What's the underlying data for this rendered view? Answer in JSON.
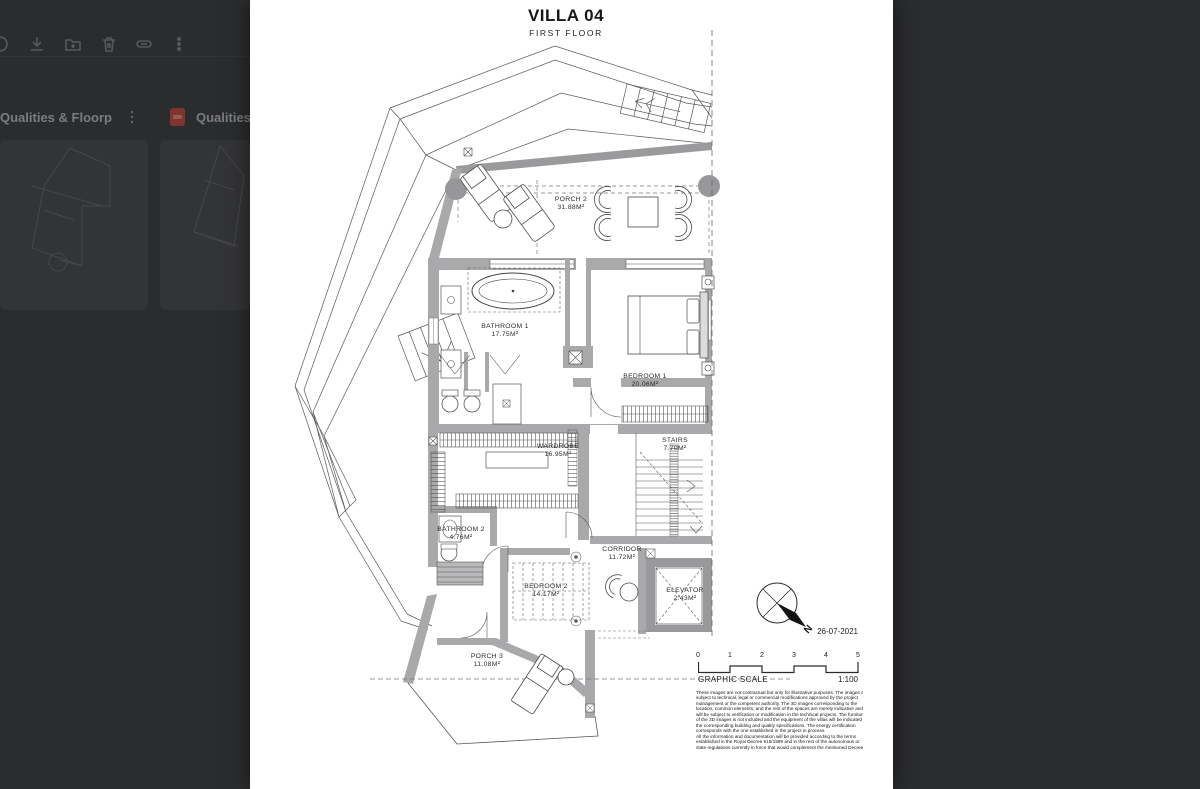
{
  "backdrop": {
    "toolbar": {
      "icons": [
        "partial-icon",
        "download-icon",
        "add-to-folder-icon",
        "trash-icon",
        "link-icon",
        "more-options-icon"
      ]
    },
    "cards": [
      {
        "title": "Qualities & Floorpla...",
        "type": "pdf"
      },
      {
        "title": "Qualities & Floorpla...",
        "type": "pdf"
      }
    ]
  },
  "document": {
    "title": "VILLA 04",
    "subtitle": "FIRST FLOOR",
    "date": "26-07-2021",
    "compass_label": "N",
    "rooms": [
      {
        "name": "PORCH 2",
        "area": "31.88M²"
      },
      {
        "name": "BATHROOM 1",
        "area": "17.75M²"
      },
      {
        "name": "BEDROOM 1",
        "area": "20.06M²"
      },
      {
        "name": "WARDROBE",
        "area": "16.95M²"
      },
      {
        "name": "STAIRS",
        "area": "7.70M²"
      },
      {
        "name": "BATHROOM 2",
        "area": "4.76M²"
      },
      {
        "name": "CORRIDOR",
        "area": "11.72M²"
      },
      {
        "name": "BEDROOM 2",
        "area": "14.17M²"
      },
      {
        "name": "ELEVATOR",
        "area": "2.43M²"
      },
      {
        "name": "PORCH 3",
        "area": "11.08M²"
      }
    ],
    "scale": {
      "ticks": [
        "0",
        "1",
        "2",
        "3",
        "4",
        "5"
      ],
      "label": "GRAPHIC SCALE",
      "ratio": "1:100"
    },
    "disclaimer": {
      "lines": [
        "These images are not contractual but only for illustrative purposes. The images are",
        "subject to technical, legal or commercial modifications approved by the project",
        "management or the competent authority. The 3D images corresponding to the",
        "location, common elements, and the rest of the spaces are merely indicative and",
        "will be subject to verification or modification in the technical projects. The furniture",
        "of the 3D images is not included and the equipment of the villas will be indicated in",
        "the corresponding building and quality specifications. The energy certification",
        "corresponds with the one established in the project in process.",
        "All the information and documentation will be provided according to the terms",
        "established in the Royal Decree 515/1989 and in the rest of the autonomous or",
        "state regulations currently in force that would complement the mentioned Decree."
      ]
    }
  }
}
